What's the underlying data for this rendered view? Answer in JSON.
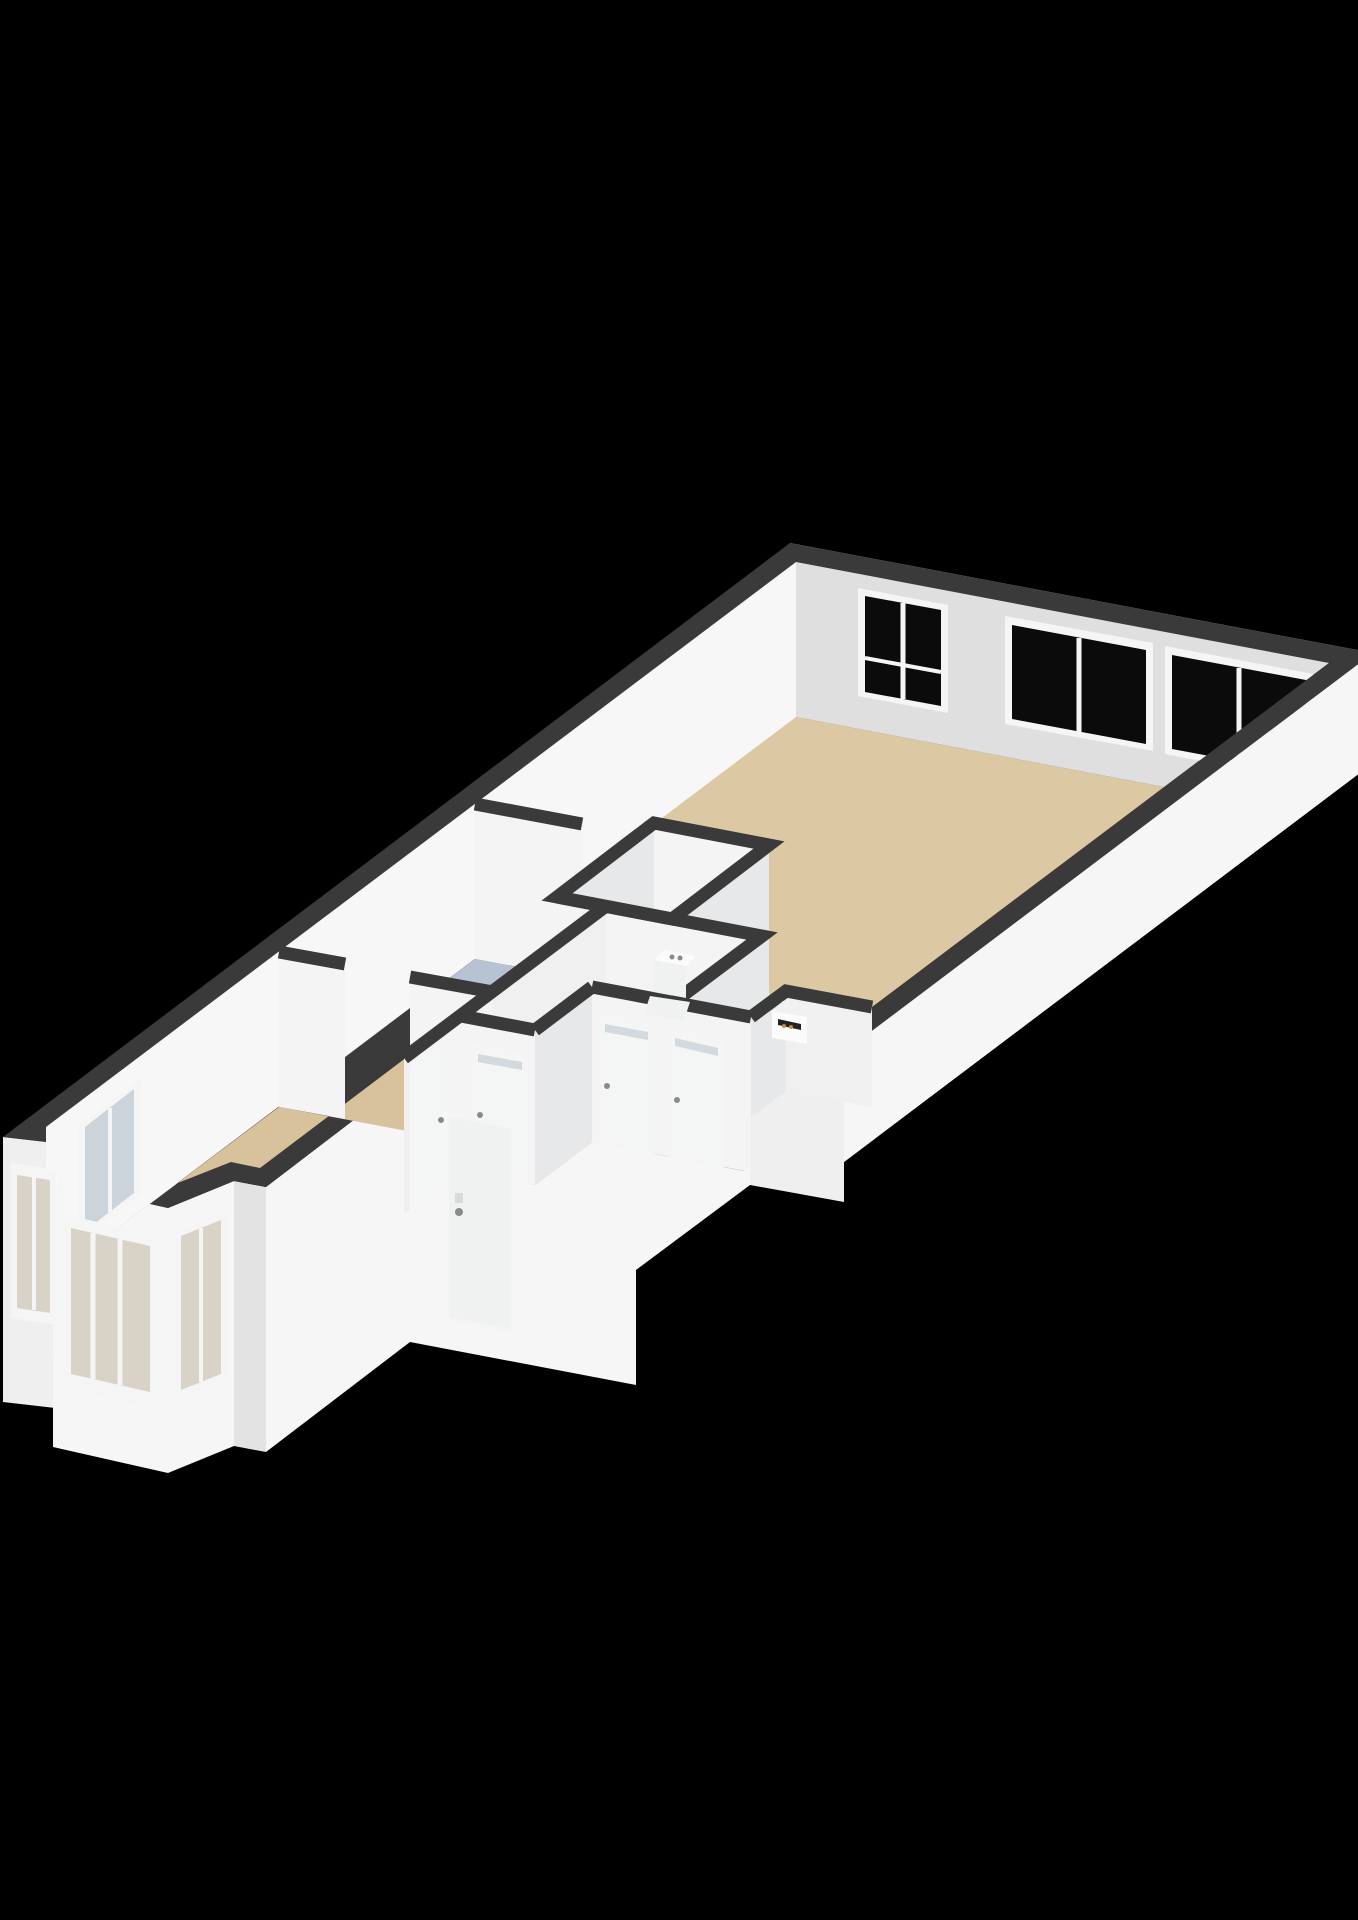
{
  "scene": {
    "type": "3d-floorplan-render",
    "view": "isometric-dollhouse",
    "rooms": [
      {
        "id": "living-room",
        "floor": "floor_living"
      },
      {
        "id": "kitchen",
        "floor": "floor_kitchen"
      },
      {
        "id": "toilet-room",
        "floor": "floor_utility"
      },
      {
        "id": "vestibule",
        "floor": "floor_utility"
      },
      {
        "id": "shower-room",
        "floor": "floor_utility"
      },
      {
        "id": "hallway",
        "floor": "floor_hall"
      },
      {
        "id": "bedroom",
        "floor": "floor_bedroom"
      },
      {
        "id": "bay-window-nook",
        "floor": "floor_bedroom"
      },
      {
        "id": "fireplace-niche",
        "floor": "floor_niche"
      }
    ],
    "fixtures": [
      {
        "id": "toilet"
      },
      {
        "id": "fireplace"
      }
    ],
    "openings": {
      "exterior_windows": 8,
      "interior_doors": 4,
      "front_doors": 1
    }
  },
  "colors": {
    "background": "#000000",
    "wall_top": "#3a3a3a",
    "outer_bright": "#f6f6f6",
    "outer_mid": "#efefef",
    "outer_dim": "#e3e3e3",
    "inner_nw": "#f7f7f7",
    "inner_ne": "#dfdfdf",
    "face_lit": "#f4f4f4",
    "face_mid": "#f0f0f0",
    "face_se": "#e7e8e9",
    "floor_living": "#dcc9a4",
    "floor_bedroom": "#d8c29c",
    "floor_kitchen": "#b7c3d2",
    "floor_hall": "#d2a160",
    "floor_utility": "#ebecec",
    "floor_niche": "#e8e9ea",
    "glass_dark": "#0b0b0b",
    "glass_light": "#ccd4db",
    "glass_bay": "#d9d3c7",
    "frame": "#f5f5f5",
    "door": "#f4f5f5",
    "door_front": "#f0f1f1",
    "slit": "#d3dade",
    "fixture": "#fbfbfb",
    "fixture_mid": "#f0f1f1",
    "fixture_shadow": "#d8d9da",
    "firebox": "#222222",
    "flame": "#c98a3a",
    "handle": "#8a8a8a"
  }
}
